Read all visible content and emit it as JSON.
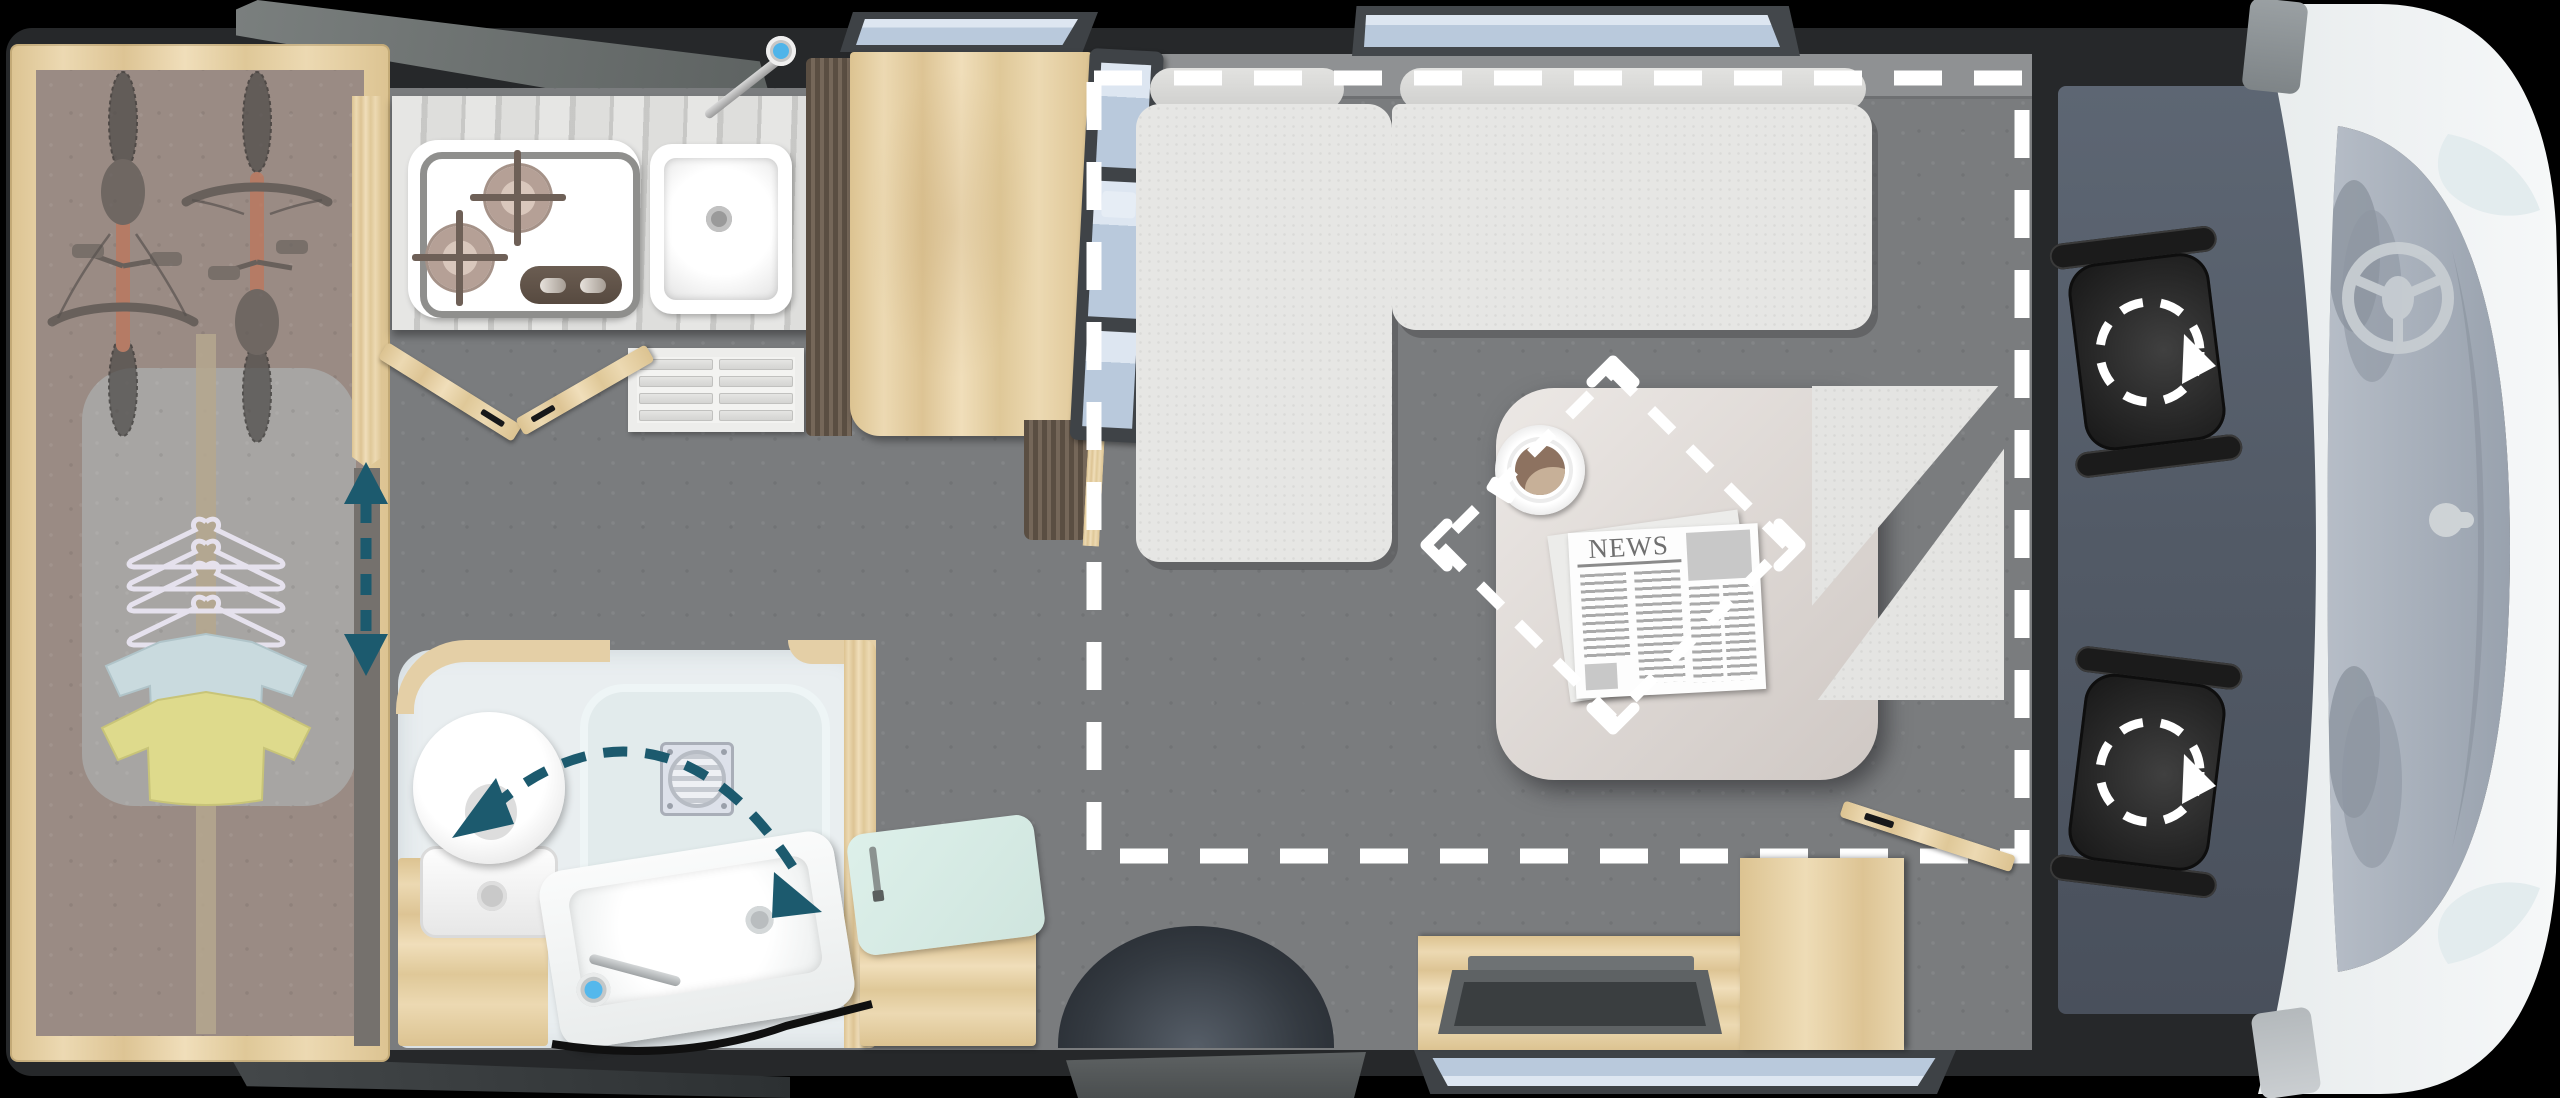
{
  "image": {
    "kind": "motorhome-floorplan-top-view",
    "width": 2560,
    "height": 1098
  },
  "newspaper": {
    "title": "NEWS"
  },
  "colors": {
    "background": "#000000",
    "body_shell": "#26282a",
    "floor_gray": "#7a7c7e",
    "garage_floor": "#9a8b84",
    "pine_wood": "#e7d4ab",
    "counter_wood": "#d8d8d6",
    "upholstery": "#e6e6e4",
    "bathroom_floor": "#e9eef0",
    "mint_cushion": "#d9ece7",
    "accent_teal": "#1c5a6e",
    "dash_white": "#ffffff",
    "glass_blue": "#bccfe2",
    "cab_body_white": "#eef1f3",
    "cab_floor": "#5b6470",
    "seat_black": "#242424",
    "bike_orange": "#c0765a",
    "shirt_blue": "#c9dade",
    "shirt_yellow": "#deda8c",
    "coffee_brown": "#8d7260"
  },
  "legend": {
    "garage": "rear-garage-with-bikes-and-wardrobe",
    "kitchen": "kitchen-two-burner-hob-and-sink",
    "bathroom": "bathroom-toilet-shower-swivel-basin",
    "lounge": "l-shaped-lounge-with-table",
    "bed": "drop-down-bed-dashed-outline",
    "cab": "driver-cab-with-two-swivel-seats",
    "counts": {
      "bikes": 2,
      "burners": 2,
      "cab_seats": 2,
      "hangers": 5,
      "shirts": 2
    }
  }
}
